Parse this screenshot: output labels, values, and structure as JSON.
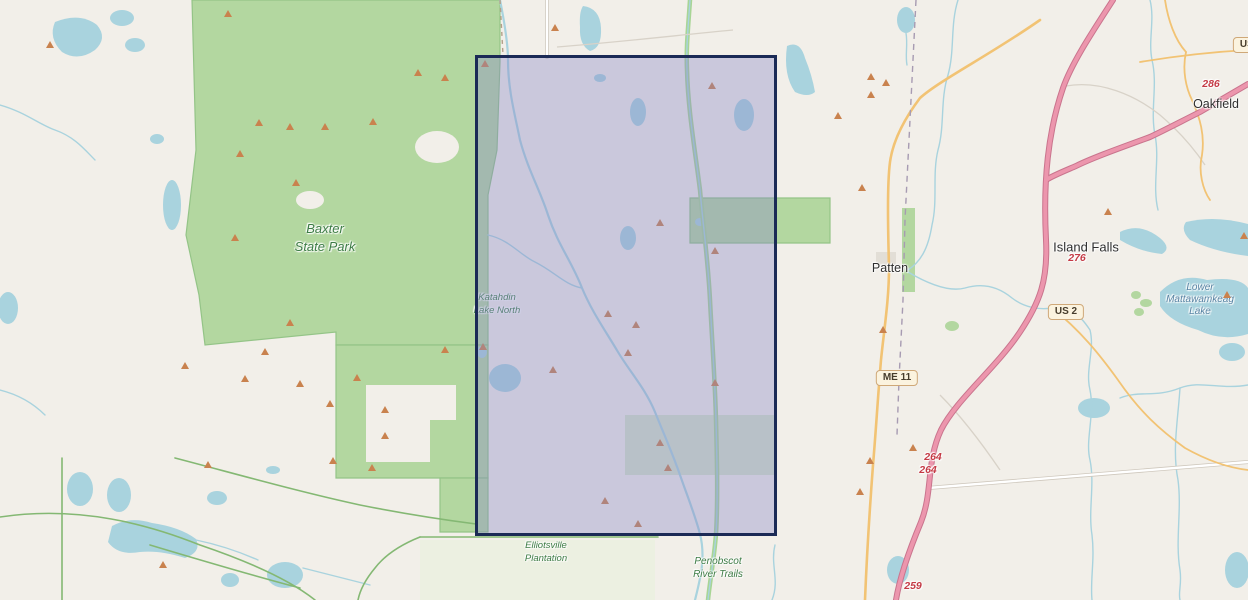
{
  "map": {
    "labels": {
      "baxter_line1": "Baxter",
      "baxter_line2": "State Park",
      "katahdin_line1": "Katahdin",
      "katahdin_line2": "Lake North",
      "elliotsville_line1": "Elliotsville",
      "elliotsville_line2": "Plantation",
      "penobscot_line1": "Penobscot",
      "penobscot_line2": "River Trails",
      "patten": "Patten",
      "island_falls": "Island Falls",
      "oakfield": "Oakfield",
      "mattawamkeag_line1": "Lower",
      "mattawamkeag_line2": "Mattawamkeag",
      "mattawamkeag_line3": "Lake"
    },
    "shields": {
      "us2": "US 2",
      "me11": "ME 11",
      "us2_edge": "US 2"
    },
    "exit_numbers": {
      "e286": "286",
      "e276": "276",
      "e264a": "264",
      "e264b": "264",
      "e259": "259"
    },
    "colors": {
      "land": "#f2efe9",
      "park": "#b3d7a0",
      "park_edge": "#94c487",
      "nature_tint": "#e9f0dd",
      "water": "#a9d3de",
      "corridor": "#a8d595",
      "trail": "#84b873",
      "gray_path": "#d8d2c8",
      "road_casing": "#cfc8bd",
      "road_orange": "#f2c374",
      "motorway": "#ec96ad",
      "motorway_casing": "#c9748d",
      "boundary": "#a79bb2",
      "label_green": "#3d7c45",
      "label_blue": "#5783a3",
      "label_town": "#2f2f2f",
      "exit_number": "#c43a45",
      "shield_bg": "#fbf3df",
      "shield_border": "#cfa878",
      "marker": "#c9824e",
      "selection_border": "#1b2a56",
      "selection_fill": "rgba(137,137,201,0.38)"
    },
    "selection": {
      "left": 475,
      "top": 55,
      "width": 302,
      "height": 481
    },
    "markers": [
      [
        50,
        47
      ],
      [
        228,
        16
      ],
      [
        259,
        125
      ],
      [
        290,
        129
      ],
      [
        325,
        129
      ],
      [
        373,
        124
      ],
      [
        418,
        75
      ],
      [
        445,
        80
      ],
      [
        240,
        156
      ],
      [
        296,
        185
      ],
      [
        235,
        240
      ],
      [
        290,
        325
      ],
      [
        265,
        354
      ],
      [
        245,
        381
      ],
      [
        185,
        368
      ],
      [
        300,
        386
      ],
      [
        330,
        406
      ],
      [
        357,
        380
      ],
      [
        385,
        412
      ],
      [
        385,
        438
      ],
      [
        372,
        470
      ],
      [
        333,
        463
      ],
      [
        445,
        352
      ],
      [
        208,
        467
      ],
      [
        163,
        567
      ],
      [
        555,
        30
      ],
      [
        485,
        66
      ],
      [
        712,
        88
      ],
      [
        660,
        225
      ],
      [
        715,
        253
      ],
      [
        608,
        316
      ],
      [
        636,
        327
      ],
      [
        628,
        355
      ],
      [
        553,
        372
      ],
      [
        483,
        349
      ],
      [
        715,
        385
      ],
      [
        660,
        445
      ],
      [
        668,
        470
      ],
      [
        605,
        503
      ],
      [
        638,
        526
      ],
      [
        871,
        79
      ],
      [
        886,
        85
      ],
      [
        871,
        97
      ],
      [
        838,
        118
      ],
      [
        862,
        190
      ],
      [
        883,
        332
      ],
      [
        870,
        463
      ],
      [
        913,
        450
      ],
      [
        860,
        494
      ],
      [
        1108,
        214
      ],
      [
        1244,
        238
      ],
      [
        1227,
        297
      ]
    ]
  }
}
